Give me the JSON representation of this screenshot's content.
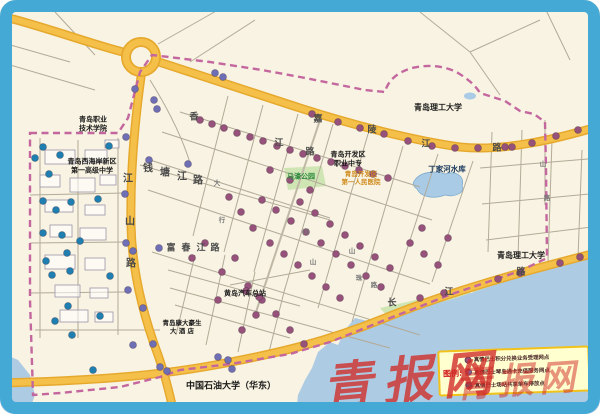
{
  "watermark": {
    "text": "青报网",
    "color": "#d02a26"
  },
  "legend": {
    "title": "图例:",
    "items": [
      {
        "color": "#96527a",
        "text": "真情巴士积分兑换业务受理网点"
      },
      {
        "color": "#6f6fb5",
        "text": "真情巴士琴岛通卡充值服务网点"
      },
      {
        "color": "#1f7fb0",
        "text": "真情巴士场站共享单车停放点"
      }
    ]
  },
  "colors": {
    "frame_blue": "#45a9d6",
    "map_bg": "#f8f3e2",
    "sea": "#aecbe4",
    "road_yellow": "#f5c049",
    "road_casing": "#e6a92e",
    "boundary_dash": "#c4679f",
    "park_green": "#cfe5b4"
  },
  "places": [
    {
      "name": "qingdao-vocational-college",
      "text": "青岛职业\n技术学院",
      "x": 93,
      "y": 124,
      "size": 7
    },
    {
      "name": "no1-senior-high-school",
      "text": "青岛西海岸新区\n第一高级中学",
      "x": 92,
      "y": 166,
      "size": 7
    },
    {
      "name": "devzone-vocational-school",
      "text": "青岛开发区\n职业中专",
      "x": 348,
      "y": 159,
      "size": 7
    },
    {
      "name": "qust-campus-north",
      "text": "青岛理工大学",
      "x": 438,
      "y": 108,
      "size": 8
    },
    {
      "name": "qust-campus-east",
      "text": "青岛理工大学",
      "x": 521,
      "y": 256,
      "size": 8
    },
    {
      "name": "dingjiahe-reservoir",
      "text": "丁家河水库",
      "x": 447,
      "y": 169,
      "size": 7.5,
      "color": "#16365c"
    },
    {
      "name": "huangdao-bus-terminal",
      "text": "黄岛汽车总站",
      "x": 245,
      "y": 294,
      "size": 7
    },
    {
      "name": "kangda-haosheng-hotel",
      "text": "青岛康大豪生\n大 酒 店",
      "x": 182,
      "y": 327,
      "size": 6.5
    },
    {
      "name": "china-univ-petroleum",
      "text": "中国石油大学（华东）",
      "x": 231,
      "y": 387,
      "size": 9
    },
    {
      "name": "mahao-park",
      "text": "马濠公园",
      "x": 301,
      "y": 177,
      "size": 7,
      "color": "#2e8b3e"
    },
    {
      "name": "no1-peoples-hospital",
      "text": "青岛开发区\n第一人民医院",
      "x": 361,
      "y": 178,
      "size": 6.5,
      "color": "#d08a1a"
    }
  ],
  "road_chars": [
    {
      "t": "江",
      "x": 128,
      "y": 177,
      "s": 10
    },
    {
      "t": "山",
      "x": 130,
      "y": 220,
      "s": 10
    },
    {
      "t": "路",
      "x": 131,
      "y": 262,
      "s": 10
    },
    {
      "t": "钱",
      "x": 148,
      "y": 167,
      "s": 10
    },
    {
      "t": "塘",
      "x": 165,
      "y": 171,
      "s": 10
    },
    {
      "t": "江",
      "x": 182,
      "y": 175,
      "s": 10
    },
    {
      "t": "路",
      "x": 198,
      "y": 179,
      "s": 10
    },
    {
      "t": "富",
      "x": 171,
      "y": 247,
      "s": 9
    },
    {
      "t": "春",
      "x": 186,
      "y": 247,
      "s": 9
    },
    {
      "t": "江",
      "x": 201,
      "y": 247,
      "s": 9
    },
    {
      "t": "路",
      "x": 215,
      "y": 247,
      "s": 9
    },
    {
      "t": "香",
      "x": 194,
      "y": 116,
      "s": 9
    },
    {
      "t": "江",
      "x": 279,
      "y": 142,
      "s": 9
    },
    {
      "t": "路",
      "x": 310,
      "y": 151,
      "s": 9
    },
    {
      "t": "嘉",
      "x": 318,
      "y": 118,
      "s": 9
    },
    {
      "t": "陵",
      "x": 372,
      "y": 129,
      "s": 9
    },
    {
      "t": "江",
      "x": 426,
      "y": 143,
      "s": 9
    },
    {
      "t": "路",
      "x": 497,
      "y": 147,
      "s": 9
    },
    {
      "t": "长",
      "x": 392,
      "y": 302,
      "s": 9
    },
    {
      "t": "江",
      "x": 449,
      "y": 291,
      "s": 9
    },
    {
      "t": "路",
      "x": 521,
      "y": 271,
      "s": 9
    },
    {
      "t": "大",
      "x": 217,
      "y": 182,
      "s": 6.5,
      "c": "#777777"
    },
    {
      "t": "行",
      "x": 222,
      "y": 219,
      "s": 6.5,
      "c": "#777777"
    },
    {
      "t": "冈",
      "x": 306,
      "y": 231,
      "s": 6.5,
      "c": "#777777"
    },
    {
      "t": "山",
      "x": 313,
      "y": 261,
      "s": 6.5,
      "c": "#777777"
    },
    {
      "t": "山",
      "x": 352,
      "y": 250,
      "s": 6.5,
      "c": "#777777"
    },
    {
      "t": "珠",
      "x": 359,
      "y": 277,
      "s": 6.5,
      "c": "#777777"
    },
    {
      "t": "路",
      "x": 374,
      "y": 284,
      "s": 6.5,
      "c": "#777777"
    },
    {
      "t": "山",
      "x": 543,
      "y": 163,
      "s": 6.5,
      "c": "#777777"
    },
    {
      "t": "路",
      "x": 547,
      "y": 197,
      "s": 6.5,
      "c": "#777777"
    }
  ],
  "dots": {
    "teal": {
      "color": "#1f7fb0",
      "points": [
        [
          43,
          147
        ],
        [
          109,
          146
        ],
        [
          60,
          155
        ],
        [
          35,
          158
        ],
        [
          49,
          174
        ],
        [
          43,
          201
        ],
        [
          98,
          199
        ],
        [
          56,
          210
        ],
        [
          71,
          202
        ],
        [
          43,
          233
        ],
        [
          62,
          235
        ],
        [
          67,
          253
        ],
        [
          46,
          261
        ],
        [
          80,
          241
        ],
        [
          52,
          275
        ],
        [
          70,
          271
        ],
        [
          110,
          276
        ],
        [
          68,
          306
        ],
        [
          100,
          316
        ],
        [
          55,
          321
        ],
        [
          72,
          335
        ],
        [
          93,
          370
        ]
      ]
    },
    "violet": {
      "color": "#6f6fb5",
      "points": [
        [
          135,
          89
        ],
        [
          154,
          100
        ],
        [
          157,
          109
        ],
        [
          126,
          137
        ],
        [
          149,
          160
        ],
        [
          188,
          164
        ],
        [
          125,
          194
        ],
        [
          126,
          243
        ],
        [
          159,
          248
        ],
        [
          133,
          251
        ],
        [
          128,
          290
        ],
        [
          143,
          308
        ],
        [
          133,
          345
        ],
        [
          153,
          344
        ],
        [
          160,
          367
        ],
        [
          167,
          371
        ],
        [
          215,
          73
        ],
        [
          223,
          77
        ],
        [
          228,
          360
        ],
        [
          232,
          369
        ],
        [
          218,
          357
        ]
      ]
    },
    "maroon": {
      "color": "#96527a",
      "points": [
        [
          200,
          120
        ],
        [
          212,
          124
        ],
        [
          224,
          128
        ],
        [
          237,
          133
        ],
        [
          250,
          137
        ],
        [
          263,
          141
        ],
        [
          277,
          146
        ],
        [
          290,
          150
        ],
        [
          303,
          154
        ],
        [
          317,
          158
        ],
        [
          331,
          162
        ],
        [
          345,
          166
        ],
        [
          359,
          170
        ],
        [
          373,
          174
        ],
        [
          388,
          178
        ],
        [
          312,
          114
        ],
        [
          338,
          122
        ],
        [
          360,
          128
        ],
        [
          384,
          134
        ],
        [
          408,
          141
        ],
        [
          432,
          146
        ],
        [
          455,
          148
        ],
        [
          478,
          148
        ],
        [
          505,
          147
        ],
        [
          512,
          147
        ],
        [
          532,
          143
        ],
        [
          556,
          136
        ],
        [
          578,
          130
        ],
        [
          262,
          200
        ],
        [
          276,
          210
        ],
        [
          291,
          221
        ],
        [
          306,
          232
        ],
        [
          321,
          243
        ],
        [
          336,
          254
        ],
        [
          351,
          265
        ],
        [
          366,
          276
        ],
        [
          381,
          287
        ],
        [
          300,
          202
        ],
        [
          315,
          213
        ],
        [
          330,
          224
        ],
        [
          345,
          235
        ],
        [
          360,
          246
        ],
        [
          375,
          257
        ],
        [
          390,
          268
        ],
        [
          270,
          243
        ],
        [
          284,
          254
        ],
        [
          298,
          265
        ],
        [
          312,
          276
        ],
        [
          326,
          287
        ],
        [
          340,
          298
        ],
        [
          241,
          212
        ],
        [
          229,
          197
        ],
        [
          253,
          228
        ],
        [
          410,
          243
        ],
        [
          424,
          254
        ],
        [
          438,
          265
        ],
        [
          422,
          228
        ],
        [
          448,
          238
        ],
        [
          235,
          258
        ],
        [
          222,
          272
        ],
        [
          248,
          286
        ],
        [
          262,
          300
        ],
        [
          276,
          314
        ],
        [
          205,
          243
        ],
        [
          192,
          258
        ],
        [
          290,
          330
        ],
        [
          304,
          344
        ],
        [
          256,
          315
        ],
        [
          242,
          330
        ],
        [
          218,
          300
        ],
        [
          310,
          190
        ],
        [
          290,
          180
        ],
        [
          270,
          170
        ],
        [
          420,
          298
        ],
        [
          444,
          293
        ],
        [
          498,
          279
        ],
        [
          520,
          273
        ],
        [
          560,
          263
        ],
        [
          580,
          257
        ],
        [
          246,
          291
        ],
        [
          259,
          297
        ]
      ]
    }
  }
}
